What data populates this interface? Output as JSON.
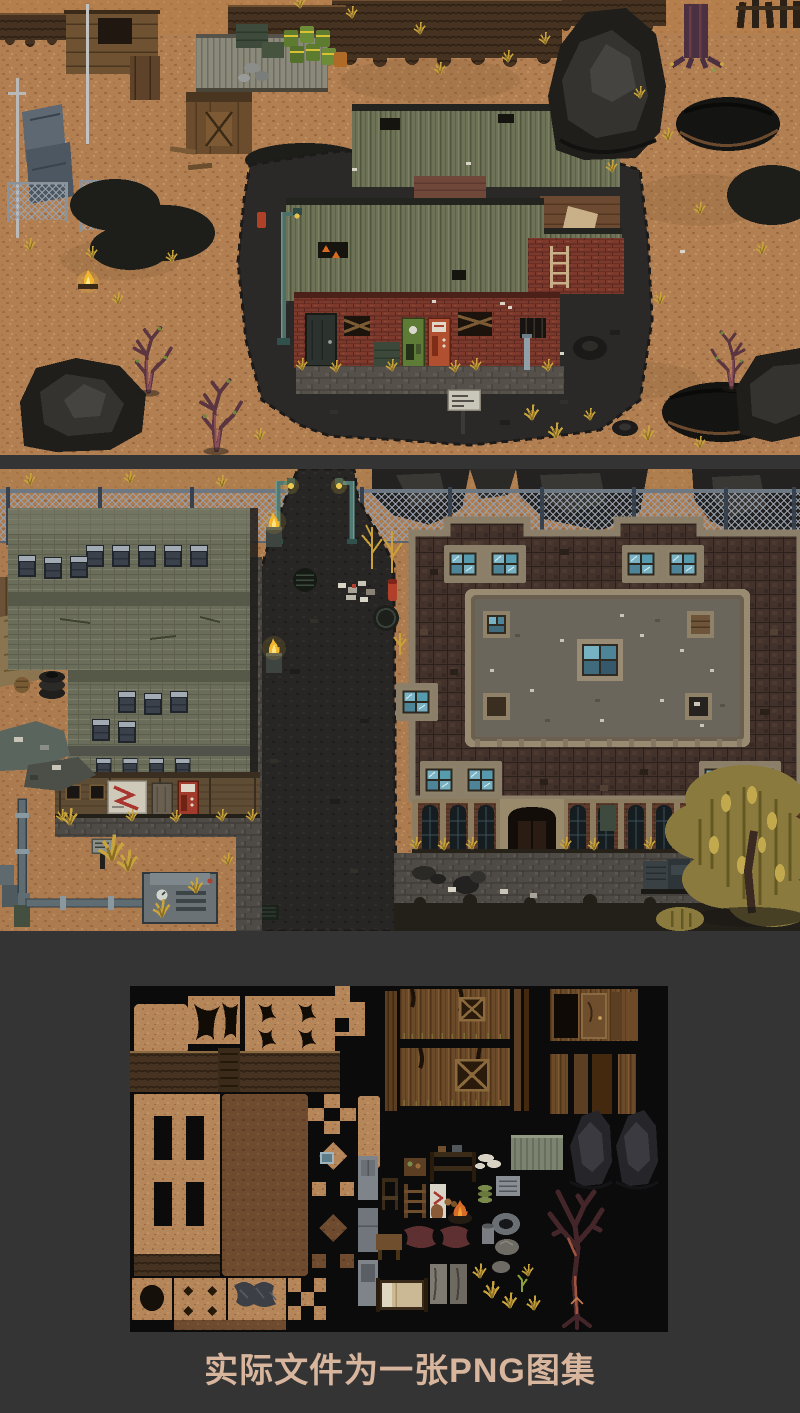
{
  "page": {
    "background_color": "#343435",
    "atlas_background": "#0b0b0b",
    "width_px": 800,
    "height_px": 1413
  },
  "caption": {
    "text": "实际文件为一张PNG图集",
    "color": "#d8b59d"
  },
  "panels": [
    {
      "id": "scene-shack",
      "alt": "pixel-art wasteland scene with corrugated-roof brick shack, junkyard, rocks and dead trees"
    },
    {
      "id": "scene-street",
      "alt": "pixel-art street scene between plank warehouse and large brick building behind chain-link fence"
    },
    {
      "id": "tileset-atlas",
      "alt": "tileset sprite atlas tiles on black background"
    }
  ],
  "palette": {
    "dirt": "#b17f52",
    "dirt_dark": "#8a5f3a",
    "asphalt": "#2a2927",
    "brick_red": "#7c392c",
    "roof_green": "#6e7357",
    "warehouse_plank": "#6b6d5b",
    "brick_roof_dark": "#42322b",
    "parapet_beige": "#8c7f69",
    "courtyard_gray": "#6b665c",
    "skylight_blue": "#77b2c2",
    "rock": "#232220",
    "fence_mesh": "#97a0ac",
    "lamp_teal": "#4f7a73",
    "grass_dry": "#c9a43c",
    "fire_yellow": "#f2b62e",
    "willow_yellow": "#8a7a3e"
  }
}
